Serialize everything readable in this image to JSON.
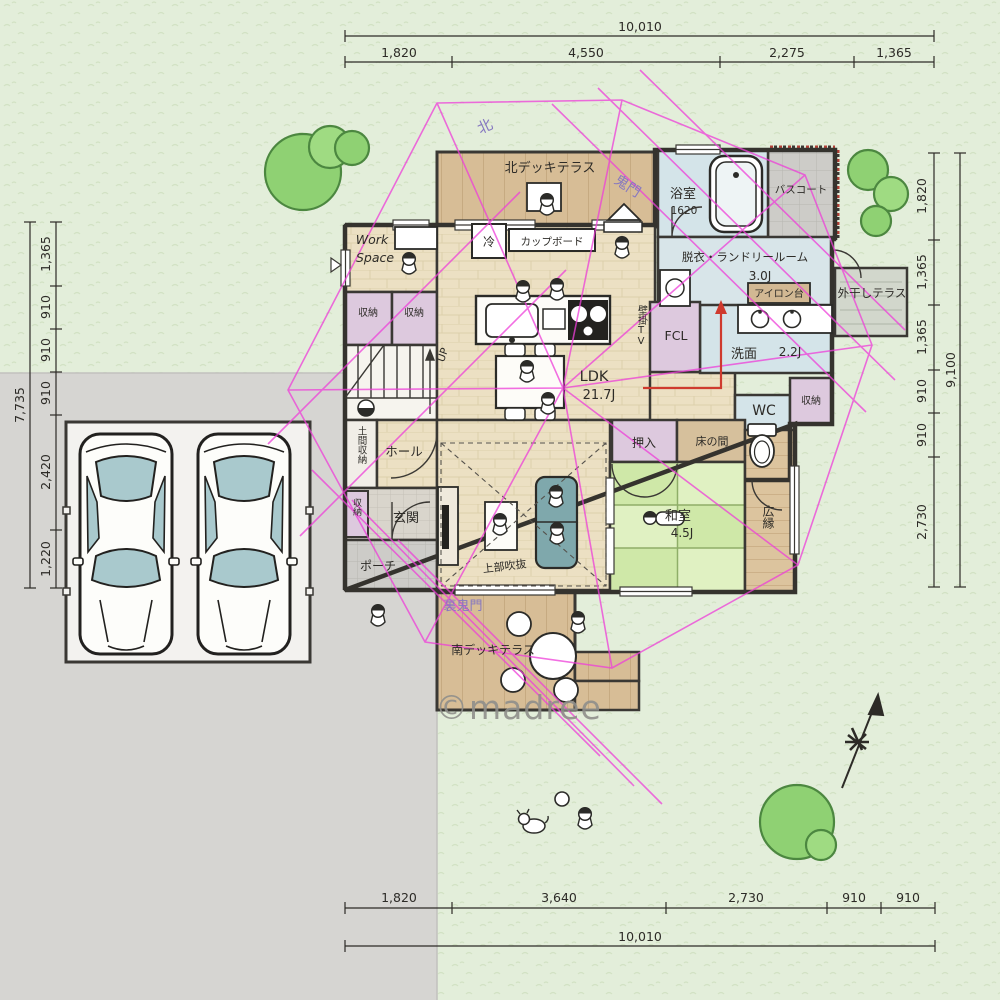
{
  "watermark": "©madree",
  "dimensions": {
    "top": {
      "total": "10,010",
      "segments": [
        "1,820",
        "4,550",
        "2,275",
        "1,365"
      ]
    },
    "bottom": {
      "total": "10,010",
      "segments": [
        "1,820",
        "3,640",
        "2,730",
        "910",
        "910"
      ]
    },
    "left": {
      "total": "7,735",
      "segments": [
        "1,365",
        "910",
        "910",
        "910",
        "2,420",
        "1,220"
      ]
    },
    "right": {
      "total": "9,100",
      "segments": [
        "1,820",
        "1,365",
        "1,365",
        "910",
        "910",
        "2,730"
      ]
    }
  },
  "compass": {
    "north": "北",
    "kimon": "鬼門",
    "ura_kimon": "裏鬼門"
  },
  "labels": {
    "north_deck": "北デッキテラス",
    "bathroom": "浴室",
    "bathroom_size": "1620",
    "bath_court": "バスコート",
    "laundry_room": "脱衣・ランドリールーム",
    "laundry_size": "3.0J",
    "ironing_board": "アイロン台",
    "drying_terrace": "外干しテラス",
    "washroom": "洗面",
    "washroom_size": "2.2J",
    "family_closet": "FCL",
    "wall_tv": "壁掛TV",
    "toilet": "WC",
    "storage_washroom": "収納",
    "fridge": "冷",
    "cupboard": "カップボード",
    "work_space_line1": "Work",
    "work_space_line2": "Space",
    "closet_a": "収納",
    "closet_b": "収納",
    "stairs_up": "UP",
    "doma_storage": "土間収納",
    "hall": "ホール",
    "entrance": "玄関",
    "entrance_closet": "収納",
    "porch": "ポーチ",
    "ldk": "LDK",
    "ldk_size": "21.7J",
    "oshiire": "押入",
    "tokonoma": "床の間",
    "japanese_room": "和室",
    "japanese_room_size": "4.5J",
    "veranda": "広縁",
    "open_ceiling": "上部吹抜",
    "south_deck": "南デッキテラス"
  }
}
